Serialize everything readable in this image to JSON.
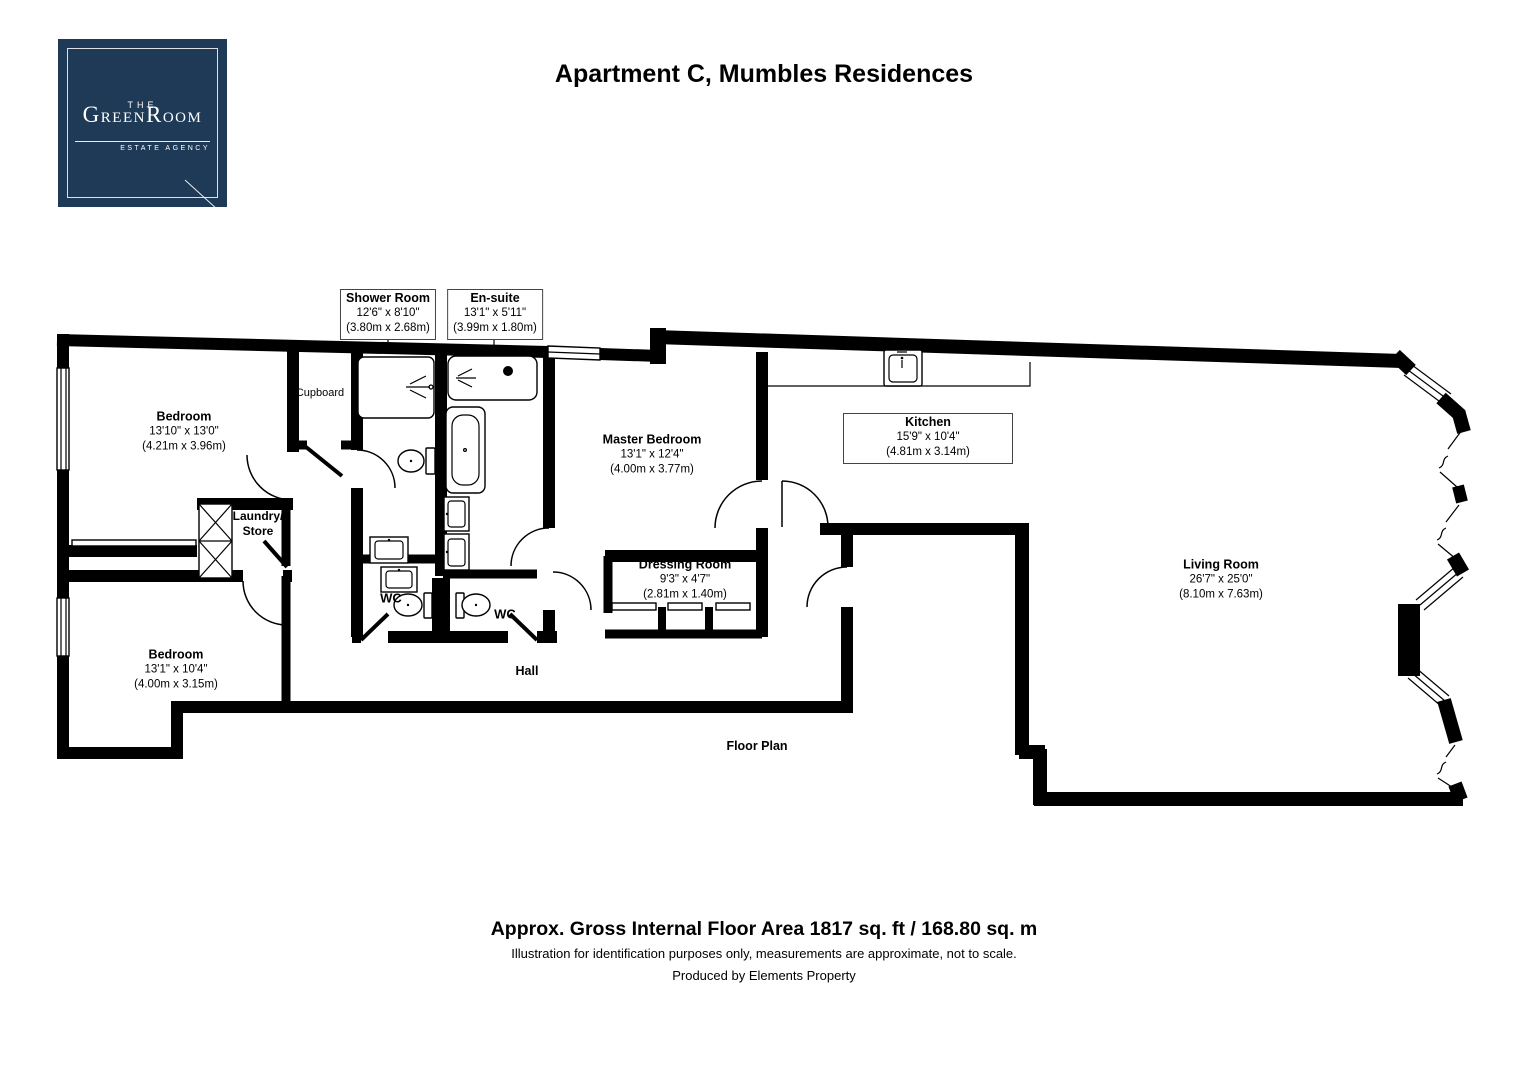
{
  "header": {
    "title": "Apartment C, Mumbles Residences"
  },
  "logo": {
    "line1": "THE",
    "g": "G",
    "reen": "REEN",
    "r": "R",
    "oom": "OOM",
    "tagline": "ESTATE AGENCY"
  },
  "theme": {
    "logo-bg": "#1e3a57",
    "wall": "#000000",
    "text": "#000000"
  },
  "rooms": {
    "bedroom1": {
      "name": "Bedroom",
      "imperial": "13'10\" x 13'0\"",
      "metric": "(4.21m x 3.96m)"
    },
    "shower_room": {
      "name": "Shower Room",
      "imperial": "12'6\" x 8'10\"",
      "metric": "(3.80m x 2.68m)"
    },
    "en_suite": {
      "name": "En-suite",
      "imperial": "13'1\" x 5'11\"",
      "metric": "(3.99m x 1.80m)"
    },
    "master_bedroom": {
      "name": "Master Bedroom",
      "imperial": "13'1\" x 12'4\"",
      "metric": "(4.00m x 3.77m)"
    },
    "kitchen": {
      "name": "Kitchen",
      "imperial": "15'9\" x 10'4\"",
      "metric": "(4.81m x 3.14m)"
    },
    "dressing_room": {
      "name": "Dressing Room",
      "imperial": "9'3\" x 4'7\"",
      "metric": "(2.81m x 1.40m)"
    },
    "living_room": {
      "name": "Living Room",
      "imperial": "26'7\" x 25'0\"",
      "metric": "(8.10m x 7.63m)"
    },
    "bedroom2": {
      "name": "Bedroom",
      "imperial": "13'1\" x 10'4\"",
      "metric": "(4.00m x 3.15m)"
    }
  },
  "annotations": {
    "cupboard": "Cupboard",
    "laundry1": "Laundry/",
    "laundry2": "Store",
    "wc_left": "WC",
    "wc_right": "WC",
    "hall": "Hall",
    "floor_plan": "Floor Plan"
  },
  "footer": {
    "area": "Approx. Gross Internal Floor Area 1817 sq. ft / 168.80 sq. m",
    "disclaimer": "Illustration for identification purposes only, measurements are approximate, not to scale.",
    "producer": "Produced by Elements Property"
  }
}
